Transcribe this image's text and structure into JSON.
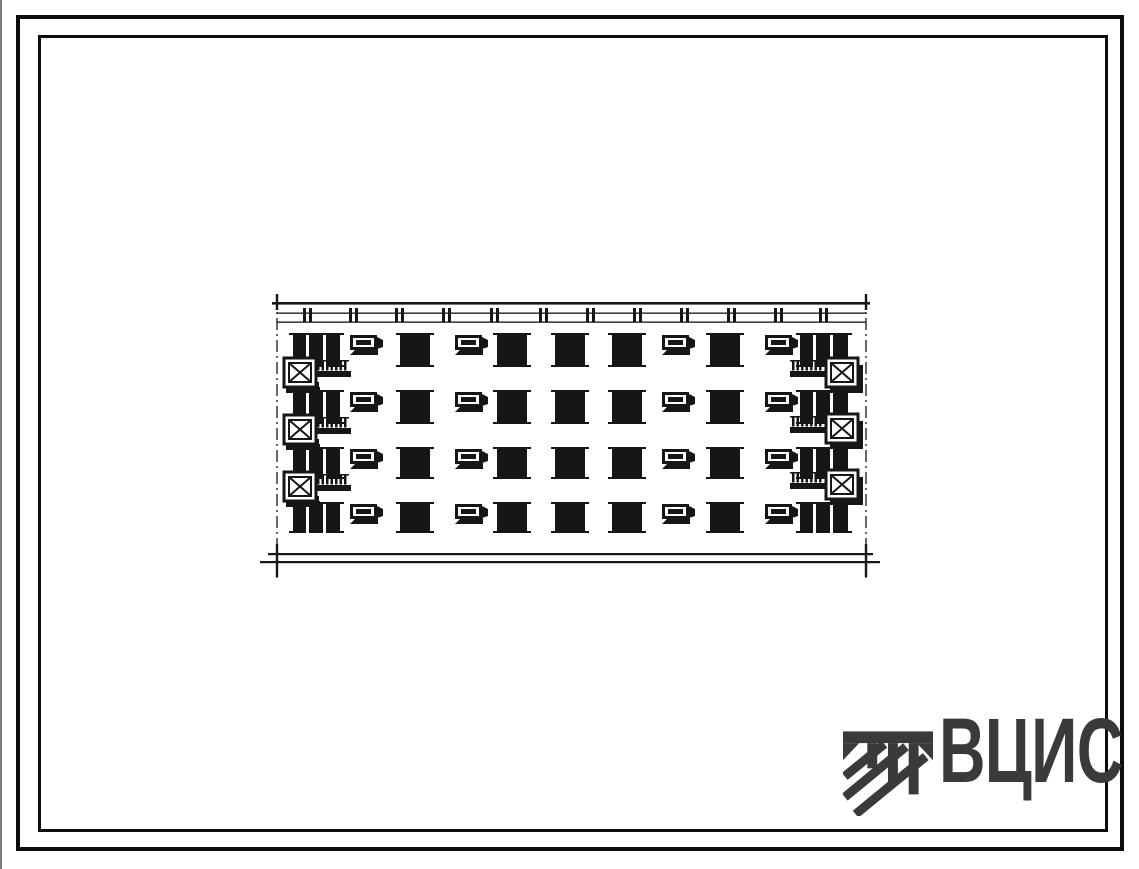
{
  "page": {
    "background": "#ffffff",
    "frame_color": "#0c0c0d",
    "scan_edge_color": "#7d7d7d"
  },
  "logo": {
    "text": "ВЦИС",
    "color": "#3a393b"
  },
  "drawing": {
    "ink_color": "#161616",
    "floors": 4,
    "floors_y": [
      40,
      97,
      154,
      209
    ],
    "floor_heights": [
      34,
      34,
      32,
      31
    ],
    "columns": [
      {
        "type": "double",
        "x": 33,
        "w": 47
      },
      {
        "type": "vent",
        "x": 90
      },
      {
        "type": "window",
        "x": 140,
        "w": 30
      },
      {
        "type": "vent",
        "x": 195
      },
      {
        "type": "window",
        "x": 237,
        "w": 30
      },
      {
        "type": "window",
        "x": 295,
        "w": 30
      },
      {
        "type": "window",
        "x": 352,
        "w": 30
      },
      {
        "type": "vent",
        "x": 402
      },
      {
        "type": "window",
        "x": 450,
        "w": 30
      },
      {
        "type": "vent",
        "x": 505
      },
      {
        "type": "double",
        "x": 540,
        "w": 48
      }
    ],
    "balconies_left_y": [
      65,
      122,
      179
    ],
    "balconies_right_y": [
      65,
      121,
      177
    ],
    "axes_x": [
      17,
      606
    ],
    "roof": {
      "x1": 12,
      "x2": 610,
      "y": 9
    },
    "cornice_lines_y": [
      19.5,
      28.5
    ],
    "chimney_ticks_x": [
      47,
      93,
      139,
      186,
      234,
      283,
      330,
      377,
      424,
      471,
      518,
      563
    ],
    "ground_lines": [
      {
        "x1": 8,
        "x2": 613,
        "y": 260
      },
      {
        "x1": 0,
        "x2": 620,
        "y": 268
      }
    ]
  }
}
